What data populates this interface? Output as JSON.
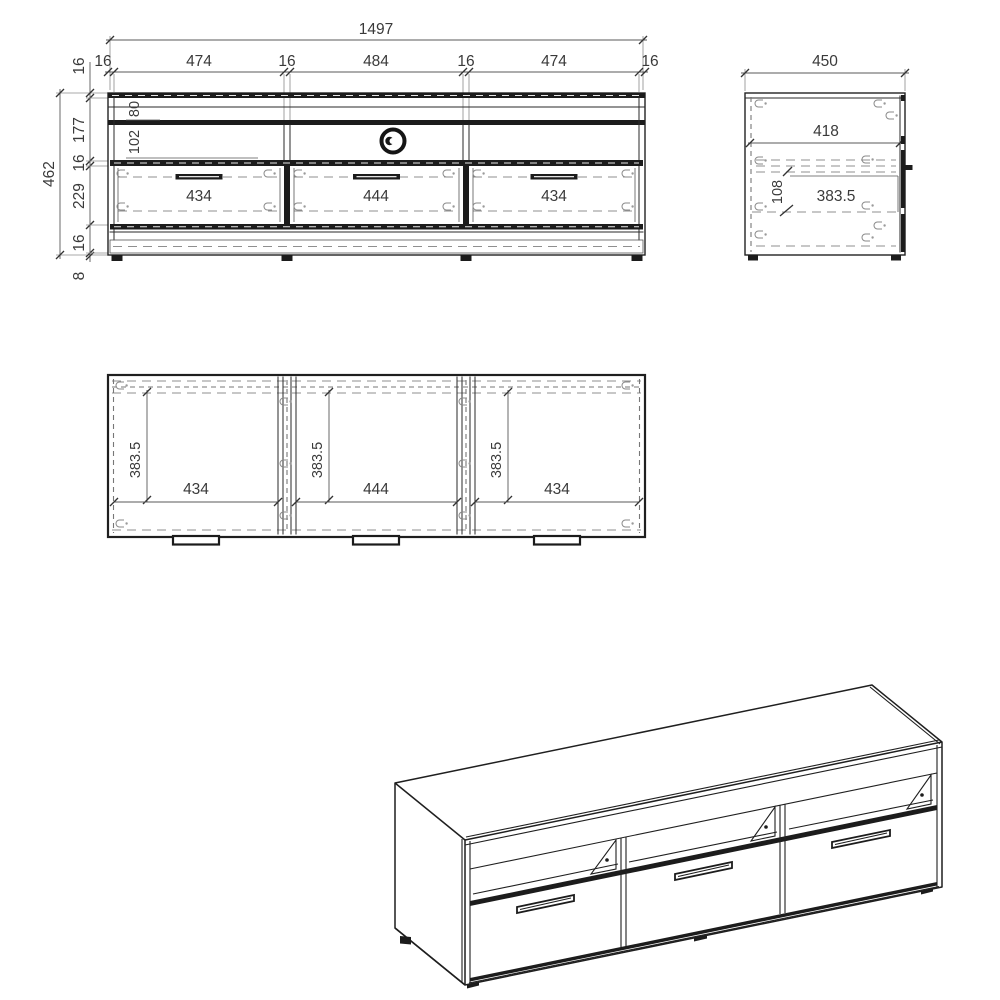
{
  "front_view": {
    "overall_width": "1497",
    "width_segments": [
      "16",
      "474",
      "16",
      "484",
      "16",
      "474",
      "16"
    ],
    "overall_height": "462",
    "height_segments": [
      "16",
      "177",
      "16",
      "229",
      "16",
      "8"
    ],
    "top_rail_height": "80",
    "open_shelf_height": "102",
    "drawer_widths": [
      "434",
      "444",
      "434"
    ]
  },
  "side_view": {
    "overall_depth": "450",
    "interior_depth": "418",
    "drawer_side_height": "108",
    "drawer_depth": "383.5"
  },
  "top_view": {
    "compartment_depths": [
      "383.5",
      "383.5",
      "383.5"
    ],
    "compartment_widths": [
      "434",
      "444",
      "434"
    ]
  },
  "colors": {
    "line": "#222222",
    "dim_text": "#3a3a3a",
    "dashed": "#8f8f8f",
    "background": "#ffffff"
  }
}
